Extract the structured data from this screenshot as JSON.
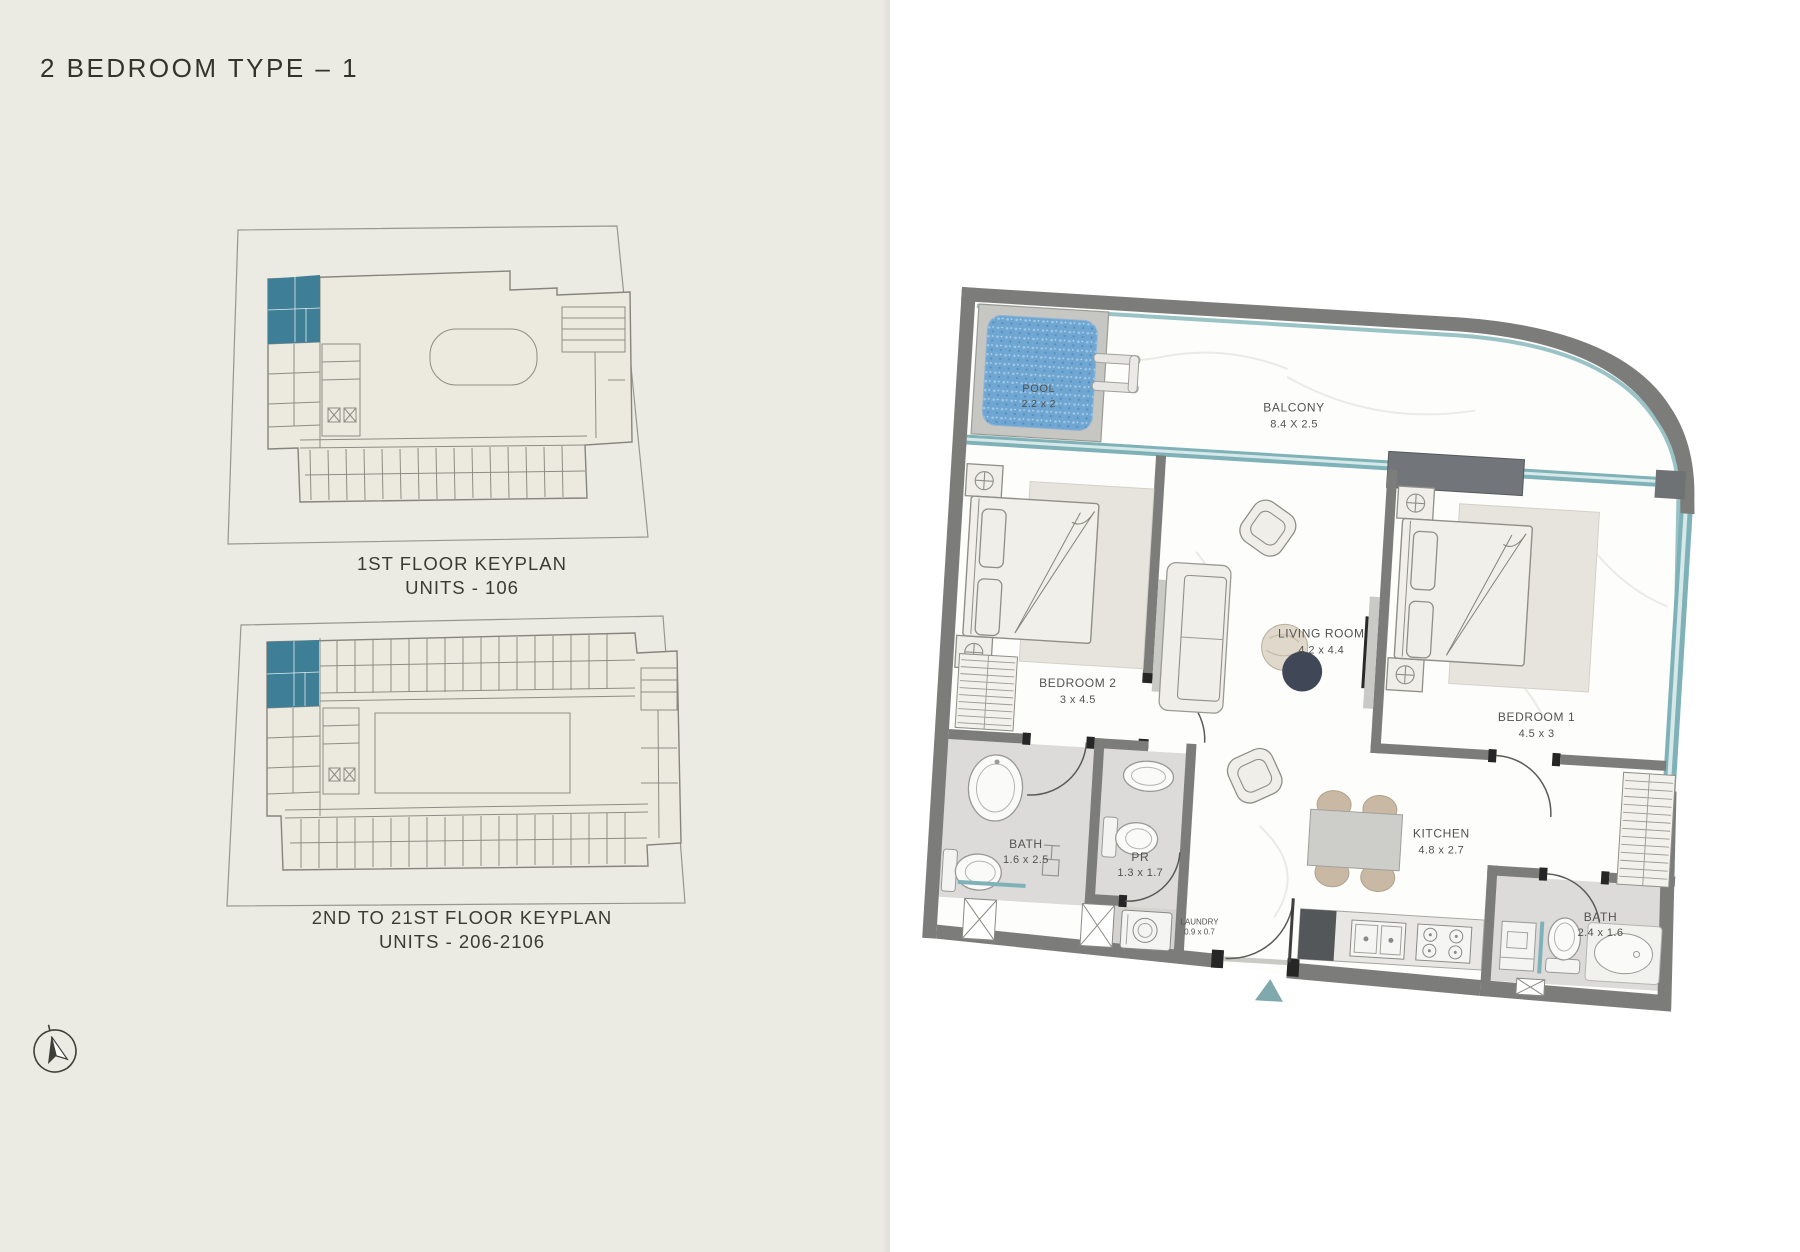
{
  "page": {
    "title": "2 BEDROOM TYPE – 1"
  },
  "keyplans": [
    {
      "line1": "1ST FLOOR KEYPLAN",
      "line2": "UNITS - 106"
    },
    {
      "line1": "2ND TO 21ST FLOOR KEYPLAN",
      "line2": "UNITS - 206-2106"
    }
  ],
  "floorplan": {
    "rooms": {
      "pool": {
        "name": "POOL",
        "dims": "2.2 x 2"
      },
      "balcony": {
        "name": "BALCONY",
        "dims": "8.4 X 2.5"
      },
      "bedroom2": {
        "name": "BEDROOM 2",
        "dims": "3 x 4.5"
      },
      "living": {
        "name": "LIVING ROOM",
        "dims": "4.2 x 4.4"
      },
      "bedroom1": {
        "name": "BEDROOM 1",
        "dims": "4.5 x 3"
      },
      "bath1": {
        "name": "BATH",
        "dims": "1.6 x 2.5"
      },
      "pr": {
        "name": "PR",
        "dims": "1.3 x 1.7"
      },
      "laundry": {
        "name": "LAUNDRY",
        "dims": "0.9 x 0.7"
      },
      "kitchen": {
        "name": "KITCHEN",
        "dims": "4.8 x 2.7"
      },
      "bath2": {
        "name": "BATH",
        "dims": "2.4 x 1.6"
      }
    }
  },
  "icons": {
    "compass": "compass-north-icon",
    "entry_marker": "entry-arrow-icon",
    "highlight_unit": "keyplan-highlighted-unit"
  },
  "colors": {
    "unit_highlight": "#3e7e97",
    "glass": "#7fb2b8",
    "glass_light": "#d7e8e9",
    "pool_water": "#6fa6d2",
    "entry_marker": "#7fa9ac",
    "panel_bg": "#ebeae3"
  }
}
